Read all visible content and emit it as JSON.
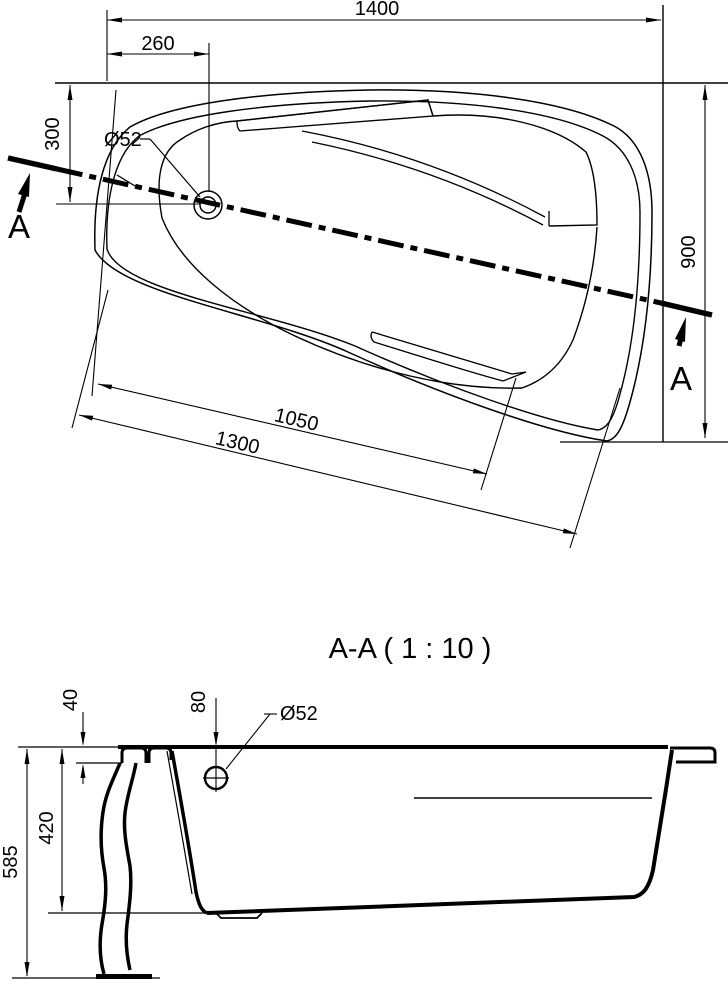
{
  "drawing": {
    "plan_view": {
      "dim_overall_width": "1400",
      "dim_drain_offset_x": "260",
      "dim_drain_offset_y": "300",
      "dim_overall_depth": "900",
      "dim_basin_length": "1050",
      "dim_rim_length": "1300",
      "drain_diameter": "Ø52",
      "section_marker_start": "A",
      "section_marker_end": "A"
    },
    "section_view": {
      "title": "A-A ( 1 : 10 )",
      "dim_rim_lip_height": "40",
      "dim_drain_depth": "80",
      "drain_diameter": "Ø52",
      "dim_shell_height": "420",
      "dim_total_height": "585"
    },
    "colors": {
      "line": "#000000",
      "background": "#ffffff"
    }
  }
}
